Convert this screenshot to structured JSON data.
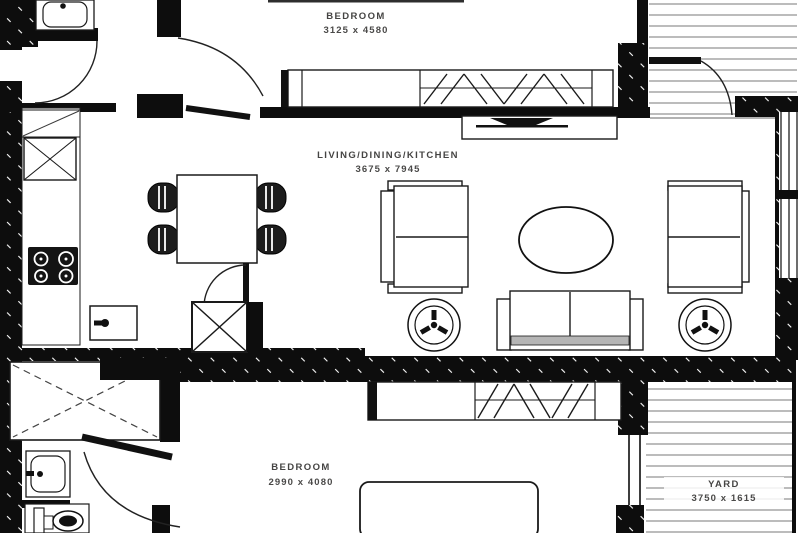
{
  "rooms": {
    "bedroom1": {
      "label": "BEDROOM",
      "size": "3125 x 4580"
    },
    "living": {
      "label": "LIVING/DINING/KITCHEN",
      "size": "3675 x 7945"
    },
    "bedroom2": {
      "label": "BEDROOM",
      "size": "2990 x 4080"
    },
    "yard": {
      "label": "YARD",
      "size": "3750 x 1615"
    }
  },
  "colors": {
    "wall": "#0d0d0d",
    "line": "#1a1a1a",
    "deck_line": "#7a7a7a",
    "label_text": "#454443",
    "background": "#ffffff",
    "sofa_band": "#b5b5b5"
  }
}
